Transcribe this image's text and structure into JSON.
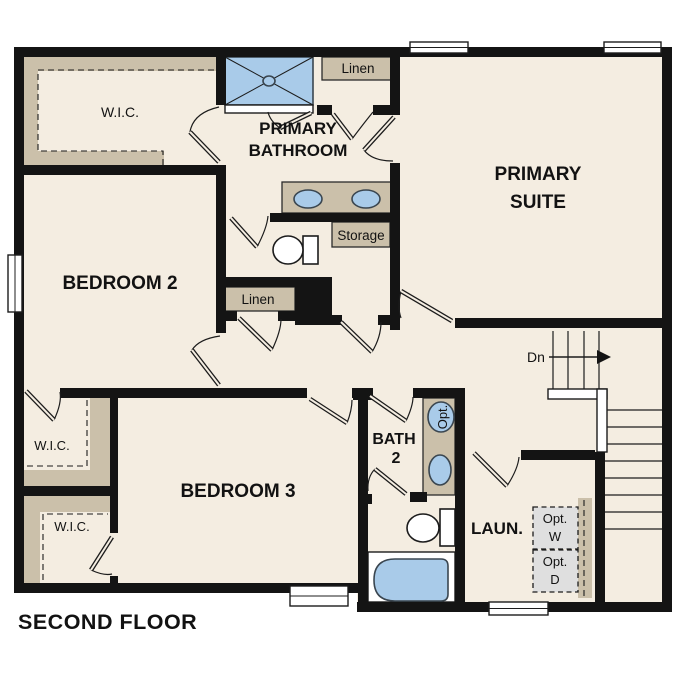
{
  "plan_title": "SECOND FLOOR",
  "rooms": {
    "bedroom2": "BEDROOM 2",
    "bedroom3": "BEDROOM 3",
    "primary_suite": [
      "PRIMARY",
      "SUITE"
    ],
    "primary_bathroom": [
      "PRIMARY",
      "BATHROOM"
    ],
    "bath2": [
      "BATH",
      "2"
    ],
    "laundry": "LAUN."
  },
  "closets": {
    "wic_primary": "W.I.C.",
    "wic_mid": "W.I.C.",
    "wic_lower": "W.I.C.",
    "linen_upper": "Linen",
    "linen_hall": "Linen",
    "storage": "Storage"
  },
  "stairs": {
    "direction_label": "Dn"
  },
  "fixtures": {
    "optional_sink": "Opt.",
    "optional_washer": [
      "Opt.",
      "W"
    ],
    "optional_dryer": [
      "Opt.",
      "D"
    ]
  },
  "colors": {
    "background": "#FFFFFF",
    "floor": "#F4EDE1",
    "wall": "#141414",
    "closet_shelf": "#CBC0AA",
    "fixture_blue": "#A9CBE9",
    "optional_appliance_fill": "#DFDFDF"
  }
}
